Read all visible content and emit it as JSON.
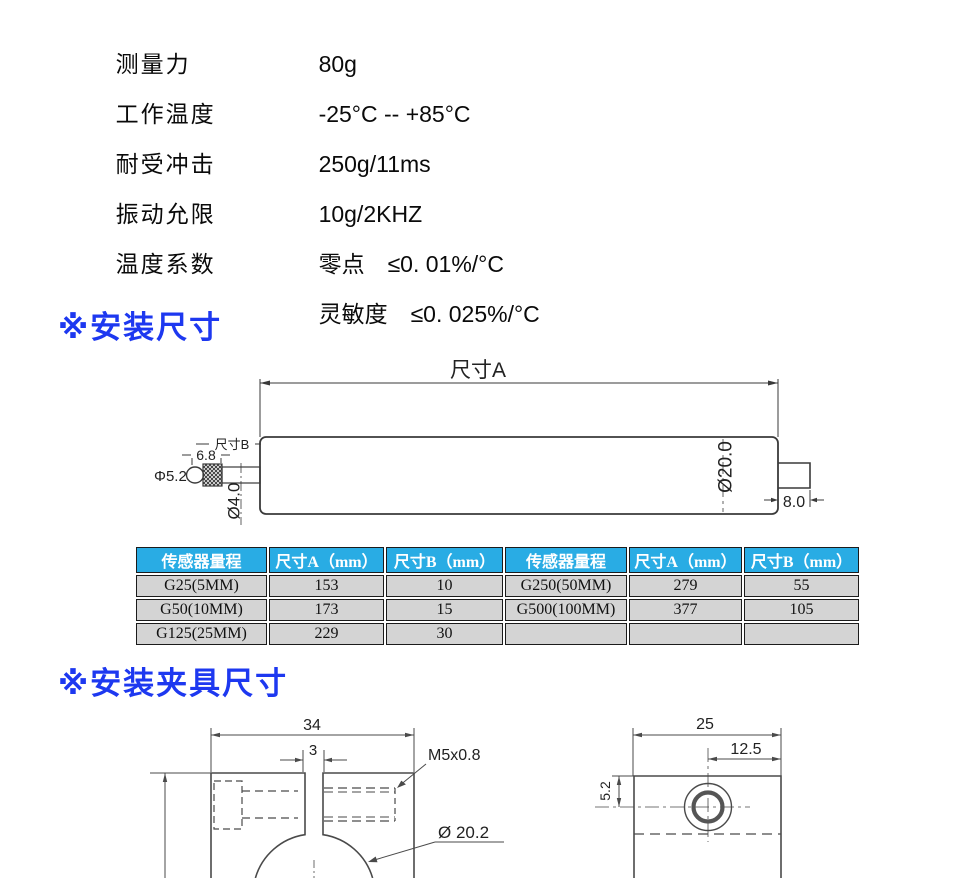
{
  "specs": {
    "rows": [
      {
        "label": "测量力",
        "value": "80g"
      },
      {
        "label": "工作温度",
        "value": "-25°C -- +85°C"
      },
      {
        "label": "耐受冲击",
        "value": "250g/11ms"
      },
      {
        "label": "振动允限",
        "value": "10g/2KHZ"
      },
      {
        "label": "温度系数",
        "value": "零点　≤0. 01%/°C"
      },
      {
        "label": "",
        "value": "灵敏度　≤0. 025%/°C"
      }
    ]
  },
  "sections": {
    "mount_heading": "※安装尺寸",
    "clamp_heading": "※安装夹具尺寸"
  },
  "sensor_drawing": {
    "dim_a": "尺寸A",
    "dim_b": "尺寸B",
    "knurl_length": "6.8",
    "tip_diameter": "Φ5.2",
    "shaft_diameter": "Ø4.0",
    "body_diameter": "Ø20.0",
    "stub_length": "8.0"
  },
  "size_table": {
    "headers": [
      "传感器量程",
      "尺寸A（mm）",
      "尺寸B（mm）",
      "传感器量程",
      "尺寸A（mm）",
      "尺寸B（mm）"
    ],
    "rows": [
      [
        "G25(5MM)",
        "153",
        "10",
        "G250(50MM)",
        "279",
        "55"
      ],
      [
        "G50(10MM)",
        "173",
        "15",
        "G500(100MM)",
        "377",
        "105"
      ],
      [
        "G125(25MM)",
        "229",
        "30",
        "",
        "",
        ""
      ]
    ]
  },
  "clamp_front_drawing": {
    "overall_width": "34",
    "slot_width": "3",
    "thread_spec": "M5x0.8",
    "bore_diameter": "Ø 20.2"
  },
  "clamp_side_drawing": {
    "overall_width": "25",
    "half_width": "12.5",
    "hole_offset": "5.2"
  },
  "colors": {
    "heading_blue": "#1d38f0",
    "table_header_bg": "#29ace4",
    "table_cell_bg": "#d4d4d4",
    "line_gray": "#3a3a3a"
  }
}
